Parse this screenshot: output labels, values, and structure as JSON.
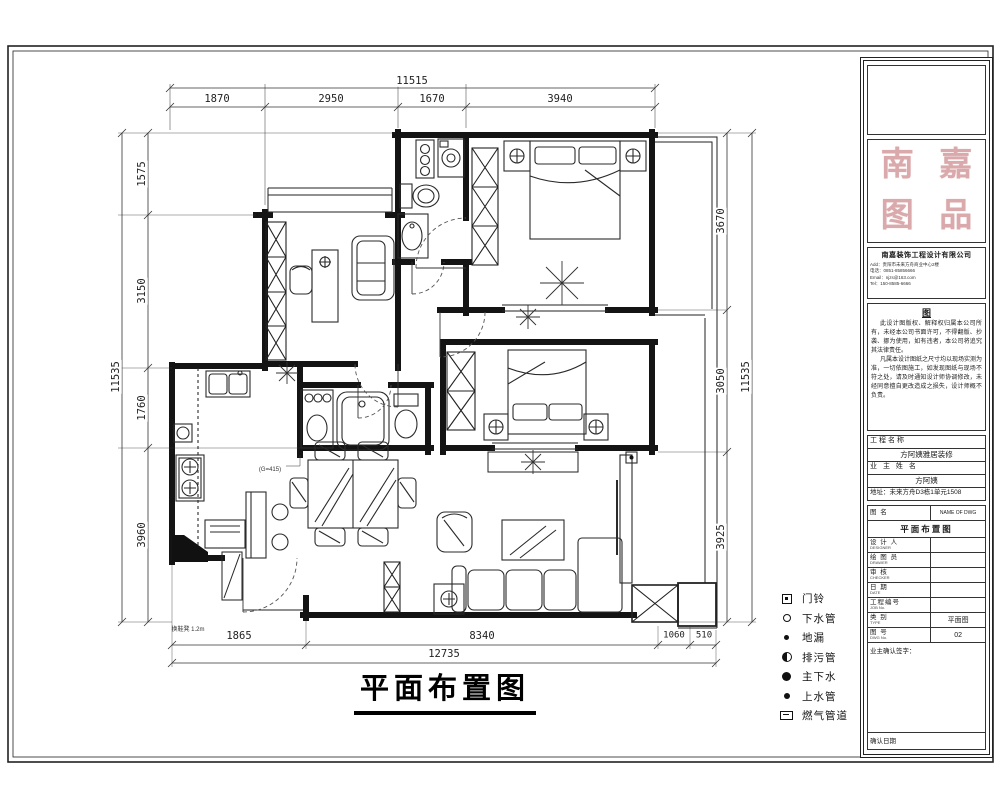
{
  "sheet": {
    "title": "平面布置图"
  },
  "dims": {
    "top_total": "11515",
    "top": [
      "1870",
      "2950",
      "1670",
      "3940"
    ],
    "left_total": "11535",
    "left": [
      "1575",
      "3150",
      "1760",
      "3960"
    ],
    "right_total": "11535",
    "right": [
      "3670",
      "3050",
      "3925"
    ],
    "bottom_total": "12735",
    "bottom": [
      "1865",
      "8340",
      "1060",
      "510"
    ]
  },
  "annotations": {
    "entry_bench": "换鞋凳 1.2m",
    "meter": "(G=415)"
  },
  "legend": {
    "items": [
      {
        "label": "门铃",
        "icon": "doorbell-icon"
      },
      {
        "label": "下水管",
        "icon": "drain-pipe-icon"
      },
      {
        "label": "地漏",
        "icon": "floor-drain-icon"
      },
      {
        "label": "排污管",
        "icon": "sewage-pipe-icon"
      },
      {
        "label": "主下水",
        "icon": "main-drain-icon"
      },
      {
        "label": "上水管",
        "icon": "water-supply-icon"
      },
      {
        "label": "燃气管道",
        "icon": "gas-pipeline-icon"
      }
    ]
  },
  "title_block": {
    "seal": [
      "南",
      "嘉",
      "图",
      "品"
    ],
    "company": {
      "name": "南嘉装饰工程设计有限公司",
      "lines": [
        "Add：贵阳市未来方舟商业中心2楼",
        "电话：0851-85856666",
        "Email：njzs@163.com",
        "Tel：150-8585-6666"
      ]
    },
    "notes": {
      "header": "图",
      "p1": "此设计图版权、解释权归属本公司所有，未经本公司书面许可，不得翻版、抄袭、挪为使用，如有违者，本公司将追究其法律责任。",
      "p2": "凡属本设计图纸之尺寸均以现场实测为准，一切依图施工，如发现图纸与现场不符之处，请及时通知设计师协调修改，未经同意擅自更改造成之损失，设计师概不负责。"
    },
    "project": {
      "name_label": "工程名称",
      "name": "方阿姨雅居装修",
      "owner_label": "业 主 姓 名",
      "owner": "方阿姨",
      "address": "地址：未来方舟D3栋1单元1508"
    },
    "table": {
      "dwg_label": "图  名",
      "dwg_label_en": "NAME OF DWG",
      "dwg_name": "平面布置图",
      "rows": [
        {
          "label": "设 计 人",
          "en": "DESIGNER",
          "value": ""
        },
        {
          "label": "绘 图 员",
          "en": "DRAWER",
          "value": ""
        },
        {
          "label": "审  核",
          "en": "CHECKER",
          "value": ""
        },
        {
          "label": "日  期",
          "en": "DATE",
          "value": ""
        },
        {
          "label": "工程编号",
          "en": "JOB No.",
          "value": ""
        },
        {
          "label": "类  别",
          "en": "TYPE",
          "value": "平面图"
        },
        {
          "label": "图  号",
          "en": "DWG No.",
          "value": "02"
        }
      ],
      "sign_label": "业主确认签字：",
      "date_label": "确认日期"
    }
  }
}
